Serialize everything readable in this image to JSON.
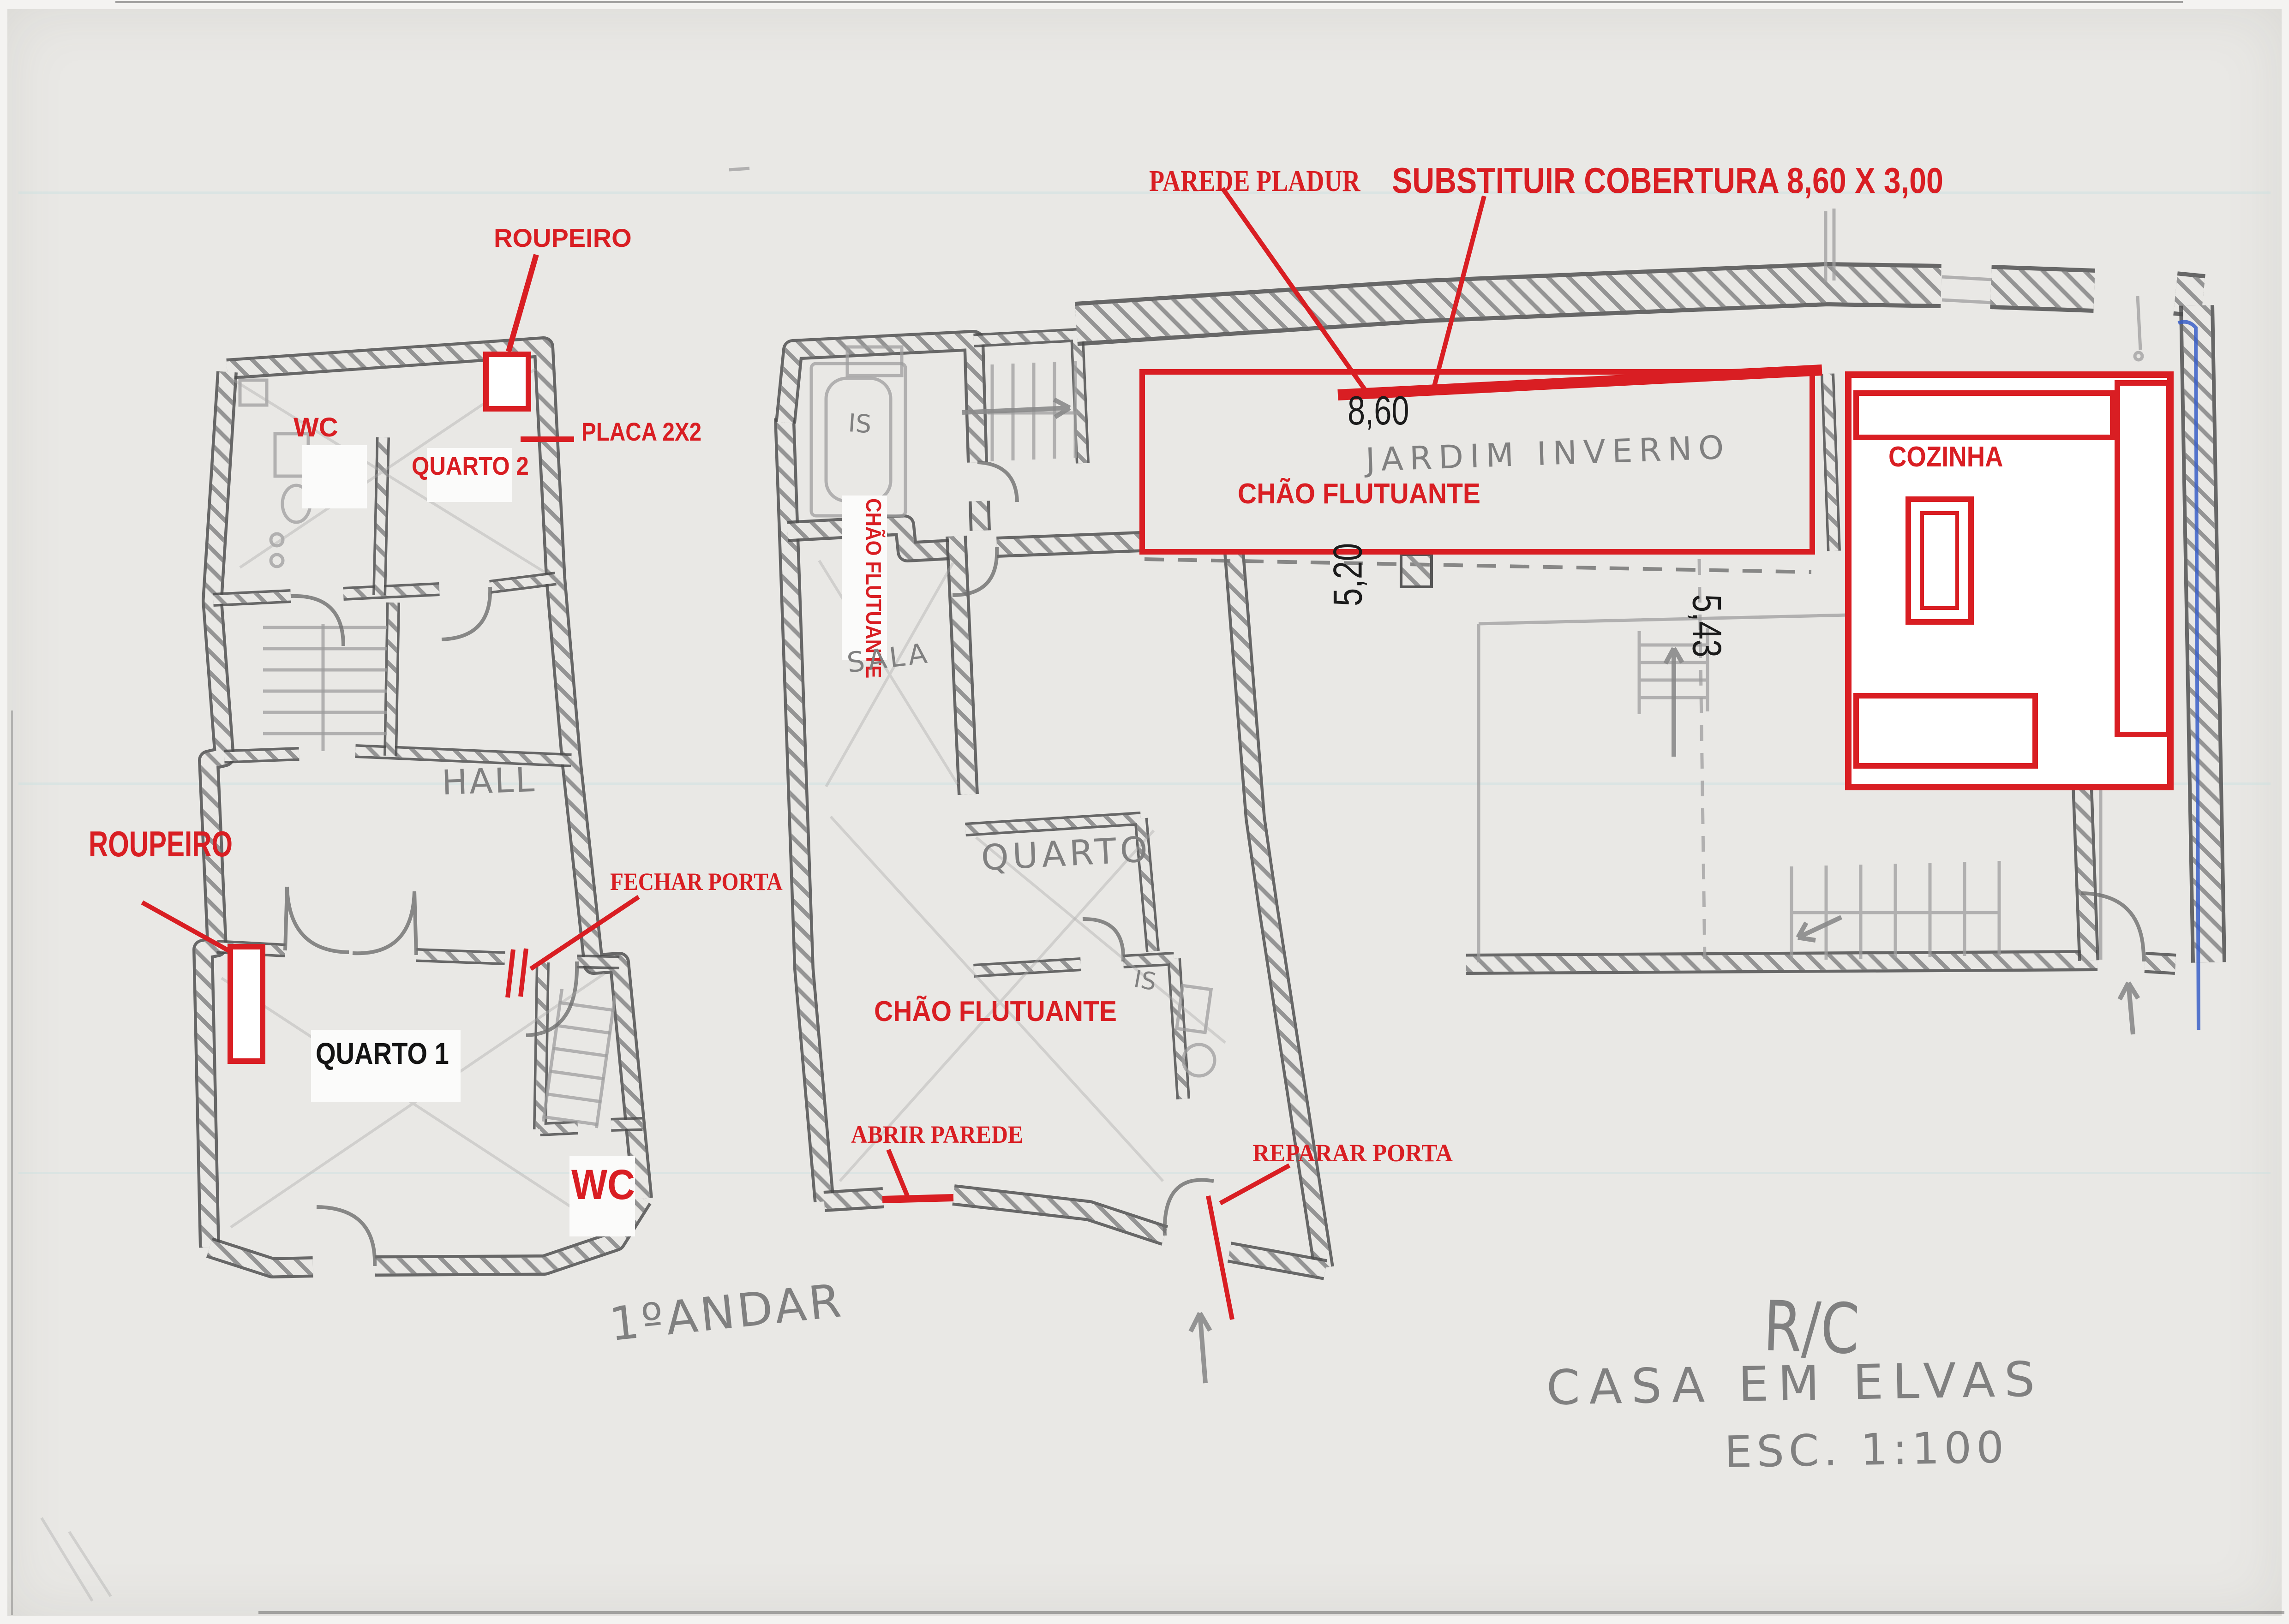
{
  "sheet": {
    "floor_label_left": "1ºANDAR",
    "floor_label_right": "R/C",
    "project_title": "CASA EM ELVAS",
    "scale_note": "ESC. 1:100"
  },
  "red_annotations": {
    "parede_pladur": "PAREDE PLADUR",
    "substituir_cobertura": "SUBSTITUIR COBERTURA 8,60 X 3,00",
    "roupeiro_top": "ROUPEIRO",
    "placa_2x2": "PLACA 2X2",
    "wc_top": "WC",
    "quarto_2": "QUARTO 2",
    "roupeiro_left": "ROUPEIRO",
    "fechar_porta": "FECHAR PORTA",
    "wc_bottom": "WC",
    "chao_flutuante_sala": "CHÃO FLUTUANTE",
    "chao_flutuante_jardim": "CHÃO FLUTUANTE",
    "chao_flutuante_quarto": "CHÃO FLUTUANTE",
    "abrir_parede": "ABRIR PAREDE",
    "reparar_porta": "REPARAR PORTA",
    "cozinha": "COZINHA"
  },
  "black_labels": {
    "quarto_1": "QUARTO 1"
  },
  "dimensions": {
    "jardim_width": "8,60",
    "span_left": "5,20",
    "span_right": "5,43"
  },
  "pencil_notes": {
    "hall": "HALL",
    "sala": "SALA",
    "quarto": "QUARTO",
    "is_upper": "IS",
    "is_lower": "IS",
    "jardim_inverno": "JARDIM INVERNO"
  },
  "colors": {
    "annotation_red": "#d91e23",
    "pencil_gray": "#8a8a8a",
    "wall_dark": "#4a4a4a",
    "paper": "#e9e8e5",
    "ink_black": "#141414",
    "pen_blue": "#3a5fc8"
  }
}
